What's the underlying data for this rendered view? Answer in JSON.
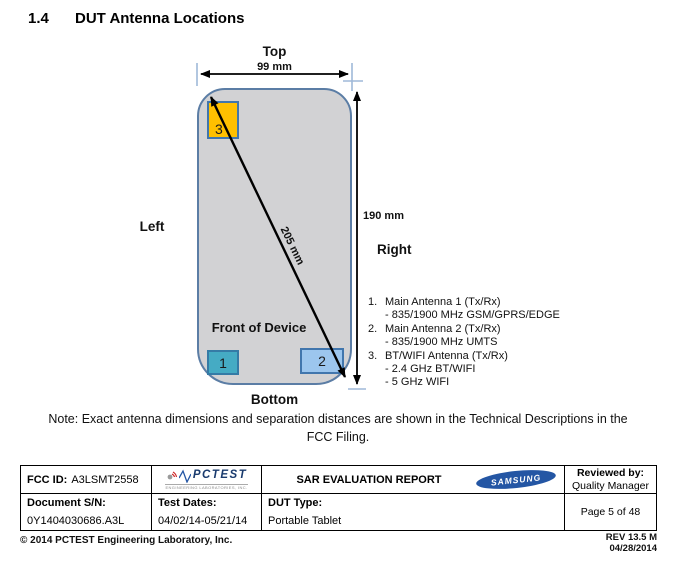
{
  "header": {
    "section_number": "1.4",
    "section_title": "DUT Antenna Locations"
  },
  "diagram": {
    "top_label": "Top",
    "bottom_label": "Bottom",
    "left_label": "Left",
    "right_label": "Right",
    "front_label": "Front of Device",
    "width_dimension": "99 mm",
    "height_dimension": "190 mm",
    "diagonal_dimension": "205 mm",
    "antenna_boxes": [
      {
        "label": "1"
      },
      {
        "label": "2"
      },
      {
        "label": "3"
      }
    ],
    "antenna_list": [
      {
        "number": "1.",
        "name": "Main Antenna 1 (Tx/Rx)",
        "details": [
          "- 835/1900 MHz GSM/GPRS/EDGE"
        ]
      },
      {
        "number": "2.",
        "name": "Main Antenna 2 (Tx/Rx)",
        "details": [
          "- 835/1900 MHz UMTS"
        ]
      },
      {
        "number": "3.",
        "name": "BT/WIFI Antenna (Tx/Rx)",
        "details": [
          "- 2.4 GHz BT/WIFI",
          "- 5 GHz WIFI"
        ]
      }
    ],
    "colors": {
      "device_fill": "#d2d2d4",
      "device_border": "#5b7da5",
      "antenna1_fill": "#45abc4",
      "antenna2_fill": "#9cc6ee",
      "antenna3_fill": "#ffc000",
      "box_border": "#4176ad",
      "tick_color": "#9fb9d9"
    }
  },
  "note": {
    "line1": "Note: Exact antenna dimensions and separation distances are shown in the Technical Descriptions in the",
    "line2": "FCC Filing."
  },
  "footer": {
    "fcc_id_label": "FCC ID:",
    "fcc_id_value": "A3LSMT2558",
    "pctest_logo": {
      "name": "PCTEST",
      "subtext": "ENGINEERING LABORATORIES, INC."
    },
    "report_title": "SAR EVALUATION REPORT",
    "samsung_logo_text": "SAMSUNG",
    "reviewed_by_label": "Reviewed by:",
    "reviewed_by_value": "Quality Manager",
    "document_sn_label": "Document S/N:",
    "document_sn_value": "0Y1404030686.A3L",
    "test_dates_label": "Test Dates:",
    "test_dates_value": "04/02/14-05/21/14",
    "dut_type_label": "DUT Type:",
    "dut_type_value": "Portable Tablet",
    "page_info": "Page 5 of 48",
    "copyright": "© 2014 PCTEST Engineering Laboratory, Inc.",
    "revision": "REV 13.5 M",
    "revision_date": "04/28/2014"
  }
}
